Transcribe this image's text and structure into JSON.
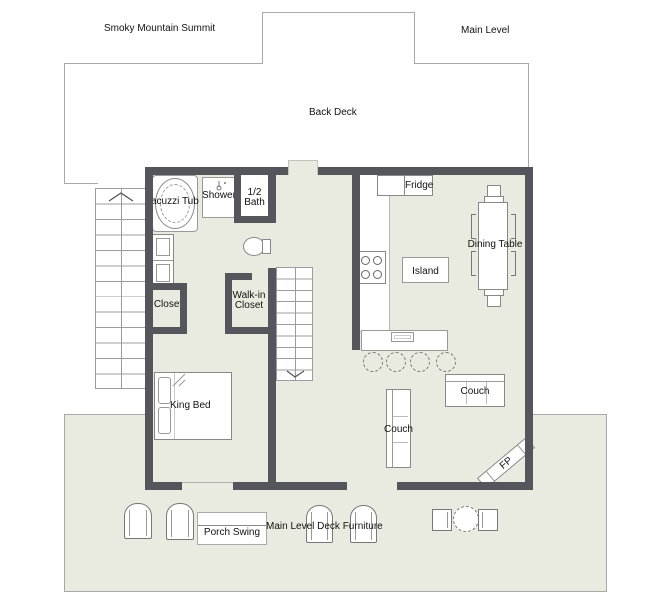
{
  "title": "Smoky Mountain Summit",
  "level_label": "Main Level",
  "deck": {
    "back_label": "Back Deck",
    "front_note": "Main Level Deck Furniture",
    "porch_swing": "Porch Swing"
  },
  "rooms": {
    "half_bath_l1": "1/2",
    "half_bath_l2": "Bath",
    "closet": "Closet",
    "walkin_l1": "Walk-in",
    "walkin_l2": "Closet"
  },
  "fixtures": {
    "jacuzzi": "Jacuzzi Tub",
    "shower": "Shower",
    "king_bed": "King Bed",
    "fridge": "Fridge",
    "island": "Island",
    "dining_table": "Dining Table",
    "couch": "Couch",
    "fireplace": "FP"
  },
  "colors": {
    "wall": "#55565c",
    "floor": "#eaebe0",
    "deck_border": "#a8a8a8",
    "furniture_line": "#888888",
    "text": "#111111"
  }
}
